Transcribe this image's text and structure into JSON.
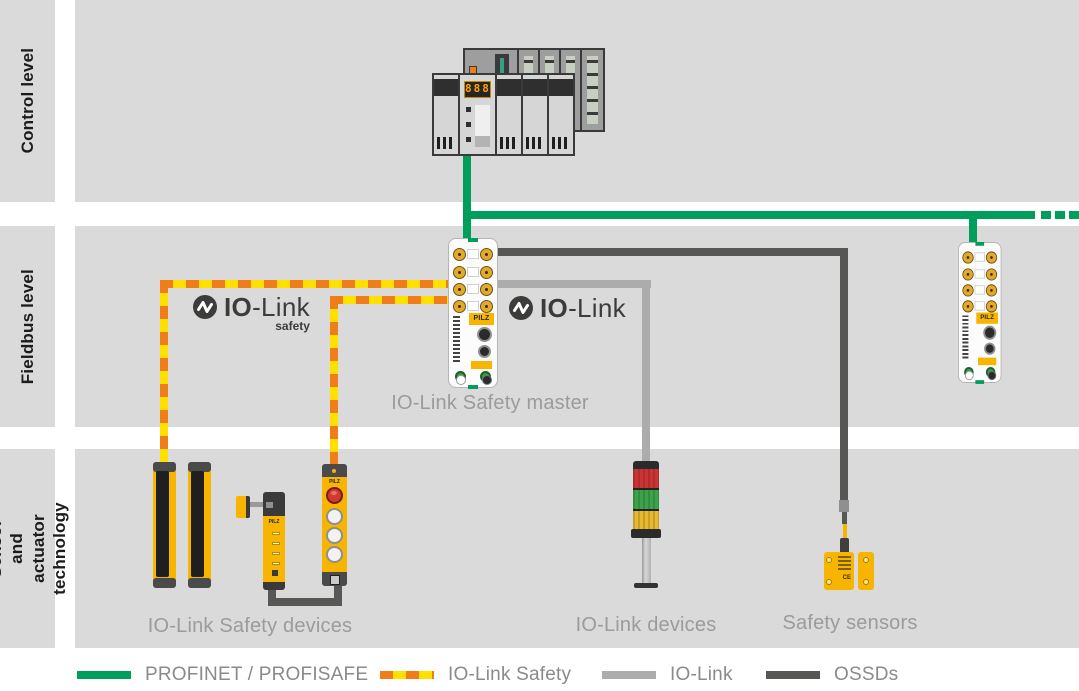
{
  "levels": [
    {
      "label": "Control level"
    },
    {
      "label": "Fieldbus level"
    },
    {
      "label": "Sensor and",
      "label2": "actuator technology"
    }
  ],
  "logo": {
    "io": "IO",
    "link": "-Link",
    "safety": "safety"
  },
  "labels": {
    "master": "IO-Link Safety master",
    "safety_devices": "IO-Link Safety devices",
    "io_devices": "IO-Link devices",
    "safety_sensors": "Safety sensors"
  },
  "devices": {
    "brand": "PILZ",
    "plc_display": "888",
    "sensor_mark": "CE"
  },
  "legend": [
    {
      "label": "PROFINET / PROFISAFE",
      "style": "solid",
      "color": "#009E5B"
    },
    {
      "label": "IO-Link Safety",
      "style": "dashed",
      "colors": [
        "#EF7D1A",
        "#FFE000"
      ]
    },
    {
      "label": "IO-Link",
      "style": "solid",
      "color": "#ACACAC"
    },
    {
      "label": "OSSDs",
      "style": "solid",
      "color": "#575756"
    }
  ],
  "colors": {
    "band_gray": "#DADADA",
    "profinet_green": "#009E5B",
    "iolink_safety_orange": "#EF7D1A",
    "iolink_safety_yellow": "#FFE000",
    "iolink_gray": "#ACACAC",
    "ossd_dark": "#575756",
    "device_yellow": "#F7B500",
    "caption_gray": "#9B9B9B",
    "logo_dark": "#3C3C3B"
  }
}
